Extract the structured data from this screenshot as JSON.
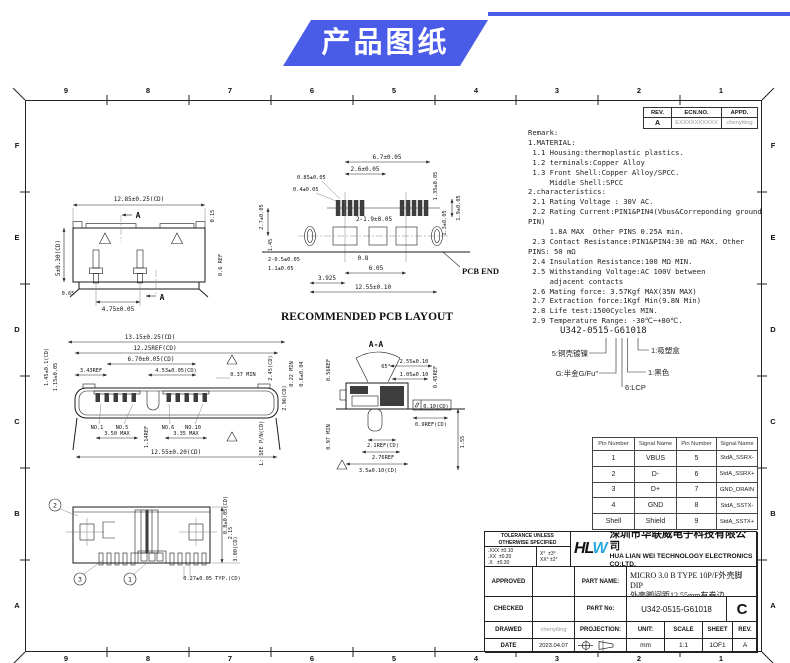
{
  "header": {
    "title": "产品图纸"
  },
  "colors": {
    "accent": "#4A5BE8",
    "logo_blue": "#29A8E0"
  },
  "frame": {
    "cols": [
      "9",
      "8",
      "7",
      "6",
      "5",
      "4",
      "3",
      "2",
      "1"
    ],
    "rows": [
      "F",
      "E",
      "D",
      "C",
      "B",
      "A"
    ]
  },
  "rev_table": {
    "h_rev": "REV.",
    "h_ecn": "ECN.NO.",
    "h_appd": "APPD.",
    "rev": "A",
    "ecn": "EXXXXXXXXXX",
    "appd": "chenyiting"
  },
  "remark": {
    "lines": [
      "Remark:",
      "1.MATERIAL:",
      " 1.1 Housing:thermoplastic plastics.",
      " 1.2 terminals:Copper Alloy",
      " 1.3 Front Shell:Copper Alloy/SPCC.",
      "     Middle Shell:SPCC",
      "2.characteristics:",
      " 2.1 Rating Voltage : 30V AC.",
      " 2.2 Rating Current:PIN1&PIN4(Vbus&Correponding ground",
      "PIN)",
      "     1.8A MAX  Other PINS 0.25A min.",
      " 2.3 Contact Resistance:PIN1&PIN4:30 mΩ MAX. Other",
      "PINS: 50 mΩ",
      " 2.4 Insulation Resistance:100 MΩ MIN.",
      " 2.5 Withstanding Voltage:AC 100V between",
      "     adjacent contacts",
      " 2.6 Mating force: 3.57Kgf MAX(35N MAX)",
      " 2.7 Extraction force:1Kgf Min(9.8N Min)",
      " 2.8 Life test:1500Cycles MIN.",
      " 2.9 Temperature Range: -30℃~+80℃."
    ]
  },
  "part_code": {
    "number": "U342-0515-G61018",
    "c_shell": "5:铜壳镀镍",
    "c_plating": "G:半金G/Fu″",
    "c_housing": "6:LCP",
    "c_color": "1:黑色",
    "c_pack": "1:吸塑盒"
  },
  "pin_table": {
    "headers": [
      "Pin Number",
      "Signal Name",
      "Pin Number",
      "Signal Name"
    ],
    "rows": [
      [
        "1",
        "VBUS",
        "5",
        "StdA_SSRX-"
      ],
      [
        "2",
        "D-",
        "6",
        "StdA_SSRX+"
      ],
      [
        "3",
        "D+",
        "7",
        "GND_DRAIN"
      ],
      [
        "4",
        "GND",
        "8",
        "StdA_SSTX-"
      ],
      [
        "Shell",
        "Shield",
        "9",
        "StdA_SSTX+"
      ]
    ]
  },
  "title_block": {
    "tolerance": {
      "line1": "TOLERANCE UNLESS",
      "line2": "OTHERWISE SPECIFIED",
      "lin": ".XXX ±0.10\n.XX  ±0.20\n.X   ±0.30",
      "ang": "X°  ±3°\nXX° ±2°"
    },
    "company": {
      "logo_black": "HL",
      "logo_blue": "W",
      "cn": "深圳市华联威电子科技有限公司",
      "en": "HUA LIAN WEI TECHNOLOGY ELECTRONICS CO;LTD."
    },
    "approved_label": "APPROVED",
    "approved": "",
    "checked_label": "CHECKED",
    "checked": "",
    "drawed_label": "DRAWED",
    "drawed": "chenyiting",
    "date_label": "DATE",
    "date": "2023.04.07",
    "part_name_label": "PART NAME:",
    "part_name_1": "MICRO 3.0 B TYPE 10P/F外壳脚DIP",
    "part_name_2": "外壳脚间距12.55mm有卷边",
    "part_no_label": "PART No:",
    "part_no": "U342-0515-G61018",
    "size": "C",
    "projection_label": "PROJECTION:",
    "unit_label": "UNIT:",
    "unit": "mm",
    "scale_label": "SCALE",
    "scale": "1:1",
    "sheet_label": "SHEET",
    "sheet": "1OF1",
    "rev_label": "REV.",
    "rev": "A"
  },
  "views": {
    "elevation": {
      "section": "A",
      "dims": [
        "12.85±0.25(CD)",
        "0.15",
        "0.6 REF",
        "5±0.30(CD)",
        "0.65",
        "4.75±0.05"
      ]
    },
    "pcb": {
      "caption": "RECOMMENDED PCB LAYOUT",
      "pcb_end": "PCB END",
      "dims": [
        "6.7±0.05",
        "2.6±0.05",
        "0.85±0.05",
        "0.4±0.05",
        "1.35±0.05",
        "2-1.9±0.05",
        "1.9±0.05",
        "1.3±0.05",
        "2.7±0.05",
        "1.45",
        "2-0.5±0.05",
        "1.1±0.05",
        "0.8",
        "6.05",
        "3.925",
        "12.55±0.10"
      ]
    },
    "front": {
      "pins": [
        "NO.1",
        "NO.5",
        "NO.6",
        "NO.10"
      ],
      "dims": [
        "13.15±0.25(CD)",
        "12.25REF(CD)",
        "6.70±0.05(CD)",
        "4.53±0.05(CD)",
        "3.43REF",
        "0.37 MIN",
        "2.45(CD)",
        "1.45±0.1(CD)",
        "1.15±0.05",
        "3.50 MAX",
        "3.35 MAX",
        "1.14REF",
        "12.55±0.20(CD)",
        "L: SEE P/N(CD)"
      ]
    },
    "section": {
      "title": "A-A",
      "dims": [
        "2.55±0.10",
        "1.05±0.10",
        "0.45REF",
        "65°",
        "0.22 MIN",
        "0.6±0.04",
        "0.56REF",
        "2.96(CD)",
        "0.97 MIN",
        "0.10(CD)",
        "0.9REF(CD)",
        "2.1REF(CD)",
        "2.76REF",
        "3.5±0.10(CD)",
        "1.55"
      ]
    },
    "bottom": {
      "balloons": [
        "2",
        "3",
        "1"
      ],
      "dims": [
        "0.8±0.05(CD)",
        "2.15",
        "3.00(CD)",
        "0.27±0.05 TYP.(CD)"
      ]
    }
  }
}
